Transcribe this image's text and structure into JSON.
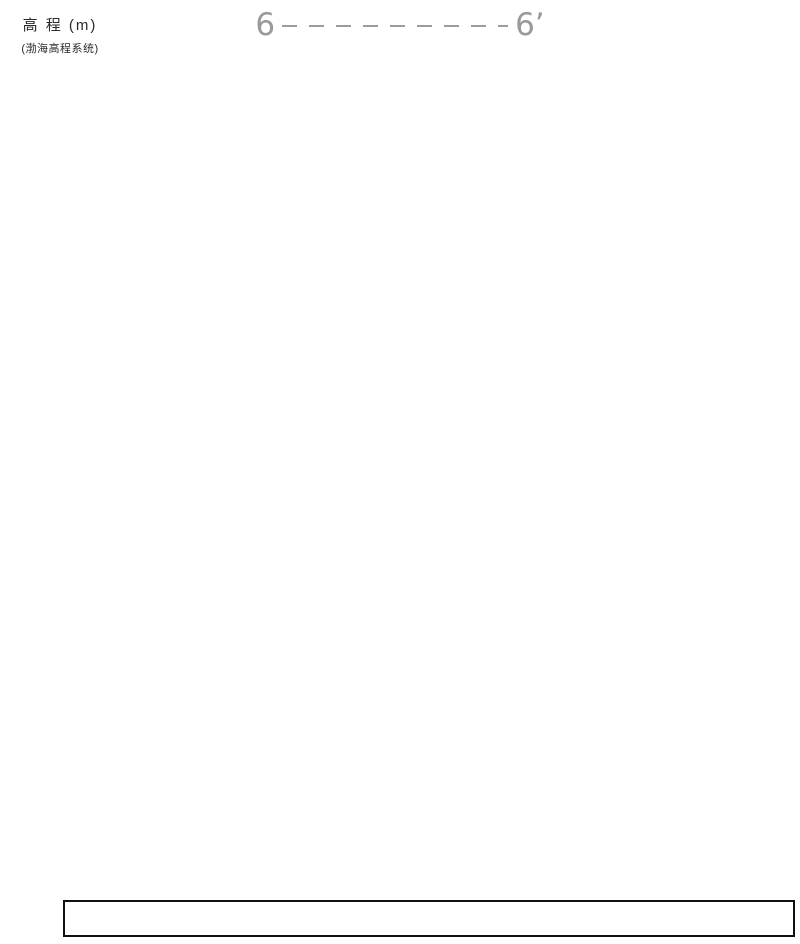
{
  "title": {
    "left": "6",
    "right": "6’"
  },
  "axis": {
    "title": "高 程 (m)",
    "subtitle": "(渤海高程系统)",
    "top_tick": 1044,
    "bottom_tick": 998,
    "step": 2
  },
  "scale": {
    "top_elev": 1044,
    "top_y": 77,
    "px_per_m": 17.545
  },
  "frame": {
    "left_x": 97,
    "left_x2": 101,
    "section_left": 95,
    "section_right": 795,
    "bottom_y": 900
  },
  "table": {
    "x_bounds": [
      63,
      131,
      400,
      727,
      795
    ],
    "cells": [
      "",
      "38.13",
      "46.30",
      ""
    ]
  },
  "boreholes": [
    {
      "name": "K35",
      "elev_label": "1040.91",
      "x": 130,
      "top_elev": 1040.91,
      "bottom_elev": 1000.91,
      "water": {
        "label": "1037.8",
        "elev": 1037.8
      },
      "samples": [
        {
          "d": "2.00",
          "open": false
        },
        {
          "d": "4.00",
          "open": false
        },
        {
          "d": "6.00",
          "open": true
        },
        {
          "d": "8.00",
          "open": false
        },
        {
          "d": "10.00",
          "open": false
        },
        {
          "d": "12.00",
          "open": false
        },
        {
          "d": "14.00",
          "open": false
        },
        {
          "d": "16.00",
          "open": false
        },
        {
          "d": "18.00",
          "open": false
        },
        {
          "d": "20.00",
          "open": false
        },
        {
          "d": "22.00",
          "open": false
        },
        {
          "d": "24.00",
          "open": false
        },
        {
          "d": "26.00",
          "open": false
        },
        {
          "d": "28.00",
          "open": false
        },
        {
          "d": "30.00",
          "open": false
        },
        {
          "d": "32.00",
          "open": true
        },
        {
          "d": "34.00",
          "open": false
        },
        {
          "d": "36.00",
          "open": false
        },
        {
          "d": "38.00",
          "open": false
        },
        {
          "d": "39.80",
          "open": true
        }
      ],
      "marks": [
        {
          "label": "0.70(1040.21)",
          "elev": 1040.21
        },
        {
          "label": "2.80(1038.11)",
          "elev": 1038.11
        },
        {
          "label": "3.40(1037.51)",
          "elev": 1037.51
        },
        {
          "label": "4.60(1036.31)",
          "elev": 1036.31
        },
        {
          "label": "7.90(1033.01)",
          "elev": 1033.01
        },
        {
          "label": "31.90(1009.01)",
          "elev": 1009.01
        },
        {
          "label": "33.70(1007.21)",
          "elev": 1007.21
        },
        {
          "label": "38.40(1002.51)",
          "elev": 1002.51
        },
        {
          "label": "40.00(1000.91)",
          "elev": 1000.91
        }
      ]
    },
    {
      "name": "K36",
      "elev_label": "1040.84",
      "x": 400,
      "top_elev": 1040.84,
      "bottom_elev": 1000.84,
      "water": {
        "label": "1037.84",
        "elev": 1037.84
      },
      "samples": [
        {
          "d": "2.00",
          "open": false
        },
        {
          "d": "4.00",
          "open": false
        },
        {
          "d": "6.00",
          "open": true
        },
        {
          "d": "8.00",
          "open": false
        },
        {
          "d": "10.00",
          "open": false
        },
        {
          "d": "12.00",
          "open": false
        },
        {
          "d": "14.00",
          "open": false
        },
        {
          "d": "16.00",
          "open": false
        },
        {
          "d": "18.00",
          "open": false
        },
        {
          "d": "20.00",
          "open": false
        },
        {
          "d": "22.00",
          "open": false
        },
        {
          "d": "24.00",
          "open": false
        },
        {
          "d": "26.00",
          "open": false
        },
        {
          "d": "28.00",
          "open": false
        },
        {
          "d": "30.00",
          "open": false
        },
        {
          "d": "32.00",
          "open": false
        },
        {
          "d": "34.00",
          "open": false
        },
        {
          "d": "36.00",
          "open": false
        },
        {
          "d": "38.00",
          "open": false
        },
        {
          "d": "39.80",
          "open": false
        }
      ],
      "marks": [
        {
          "label": "0.50(1040.34)",
          "elev": 1040.34
        },
        {
          "label": "2.00(1038.84)",
          "elev": 1038.84
        },
        {
          "label": "3.40(1037.44)",
          "elev": 1037.44
        },
        {
          "label": "4.60(1036.24)",
          "elev": 1036.24
        },
        {
          "label": "7.40(1033.44)",
          "elev": 1033.44
        },
        {
          "label": "35.00(1005.84)",
          "elev": 1005.84
        },
        {
          "label": "35.80(1005.04)",
          "elev": 1005.04
        },
        {
          "label": "37.30(1003.54)",
          "elev": 1003.54
        },
        {
          "label": "38.00(1002.84)",
          "elev": 1002.84
        },
        {
          "label": "40.00(1000.84)",
          "elev": 1000.84
        }
      ]
    },
    {
      "name": "K40",
      "elev_label": "1040.52",
      "x": 727,
      "top_elev": 1040.52,
      "bottom_elev": 1025.52,
      "water": {
        "label": "1037.7",
        "elev": 1037.7
      },
      "samples": [
        {
          "d": "2.00",
          "open": false
        },
        {
          "d": "4.00",
          "open": false
        },
        {
          "d": "6.00",
          "open": true
        },
        {
          "d": "8.00",
          "open": false
        },
        {
          "d": "9.80",
          "open": false
        }
      ],
      "marks": [
        {
          "label": "0.30(1040.22)",
          "elev": 1040.22
        },
        {
          "label": "2.20(1038.32)",
          "elev": 1038.32
        },
        {
          "label": "3.00(1037.52)",
          "elev": 1037.52
        },
        {
          "label": "4.30(1036.22)",
          "elev": 1036.22
        },
        {
          "label": "6.30(1034.22)",
          "elev": 1034.22
        },
        {
          "label": "15.00(1025.52)",
          "elev": 1025.52
        }
      ]
    }
  ],
  "strata_lines": {
    "ground": [
      [
        95,
        1040.91
      ],
      [
        130,
        1040.91
      ],
      [
        400,
        1040.84
      ],
      [
        727,
        1040.52
      ],
      [
        795,
        1040.45
      ]
    ],
    "b1": [
      [
        95,
        1040.21
      ],
      [
        130,
        1040.21
      ],
      [
        400,
        1040.34
      ],
      [
        727,
        1040.22
      ],
      [
        795,
        1040.2
      ]
    ],
    "b2": [
      [
        95,
        1038.11
      ],
      [
        130,
        1038.11
      ],
      [
        400,
        1038.84
      ],
      [
        727,
        1038.32
      ],
      [
        795,
        1038.3
      ]
    ],
    "b3": [
      [
        95,
        1037.51
      ],
      [
        130,
        1037.51
      ],
      [
        400,
        1037.44
      ],
      [
        727,
        1037.52
      ],
      [
        795,
        1037.52
      ]
    ],
    "b4": [
      [
        95,
        1036.31
      ],
      [
        130,
        1036.31
      ],
      [
        400,
        1036.24
      ],
      [
        727,
        1036.22
      ],
      [
        795,
        1036.22
      ]
    ],
    "b5": [
      [
        95,
        1033.01
      ],
      [
        130,
        1033.01
      ],
      [
        400,
        1033.44
      ],
      [
        727,
        1034.22
      ],
      [
        795,
        1034.3
      ]
    ],
    "b6": [
      [
        95,
        1009.01
      ],
      [
        130,
        1009.01
      ],
      [
        400,
        1005.84
      ],
      [
        567,
        1006.9
      ]
    ],
    "b7": [
      [
        95,
        1007.21
      ],
      [
        130,
        1007.21
      ],
      [
        400,
        1005.04
      ],
      [
        567,
        1005.8
      ]
    ],
    "b8": [
      [
        95,
        1002.51
      ],
      [
        130,
        1002.51
      ],
      [
        400,
        1003.54
      ],
      [
        567,
        1003.8
      ]
    ],
    "b9": [
      [
        95,
        1001.45
      ],
      [
        130,
        1001.5
      ],
      [
        400,
        1002.84
      ],
      [
        567,
        1003.05
      ]
    ],
    "bottom": [
      [
        95,
        1000.91
      ],
      [
        130,
        1000.91
      ],
      [
        400,
        1000.84
      ],
      [
        567,
        1001.2
      ]
    ]
  },
  "cut_edge_px": [
    [
      795,
      390
    ]
  ],
  "strata_labels": [
    {
      "q": "Q",
      "sub": "4",
      "sup": "ml",
      "soil": "杂填土",
      "num": "1",
      "x": 243,
      "y": 134
    },
    {
      "q": "Q",
      "sub": "4",
      "sup": "al+pl",
      "soil": "粉土",
      "num": "2",
      "x": 238,
      "y": 158
    },
    {
      "q": "Q",
      "sub": "4",
      "sup": "al+pl",
      "soil": "粉质粘土",
      "num": "3",
      "x": 226,
      "y": 184
    },
    {
      "q": "Q",
      "sub": "4",
      "sup": "al+pl",
      "soil": "粉土",
      "num": "4",
      "x": 238,
      "y": 205
    },
    {
      "q": "Q",
      "sub": "4",
      "sup": "al+pl",
      "soil": "中砂",
      "num": "5",
      "x": 235,
      "y": 239
    },
    {
      "q": "Q",
      "sub": "3",
      "sup": "al+pl",
      "soil": "粉质粘土",
      "num": "6",
      "x": 230,
      "y": 490
    },
    {
      "q": "Q",
      "sub": "3",
      "sup": "al+pl",
      "soil": "细砂",
      "num": "7",
      "x": 250,
      "y": 727
    },
    {
      "q": "Q",
      "sub": "3",
      "sup": "al+pl",
      "soil": "粉质粘土",
      "num": "8",
      "x": 235,
      "y": 764
    },
    {
      "q": "Q",
      "sub": "3",
      "sup": "al+pl",
      "soil": "中砂",
      "num": "9",
      "x": 250,
      "y": 801
    },
    {
      "q": "Q",
      "sub": "3",
      "sup": "al+pl",
      "soil": "粉质粘土",
      "num": "10",
      "x": 303,
      "y": 818
    }
  ],
  "z_marks": [
    {
      "x": 587,
      "y": 228
    },
    {
      "x": 743,
      "y": 225
    },
    {
      "x": 509,
      "y": 790
    }
  ]
}
